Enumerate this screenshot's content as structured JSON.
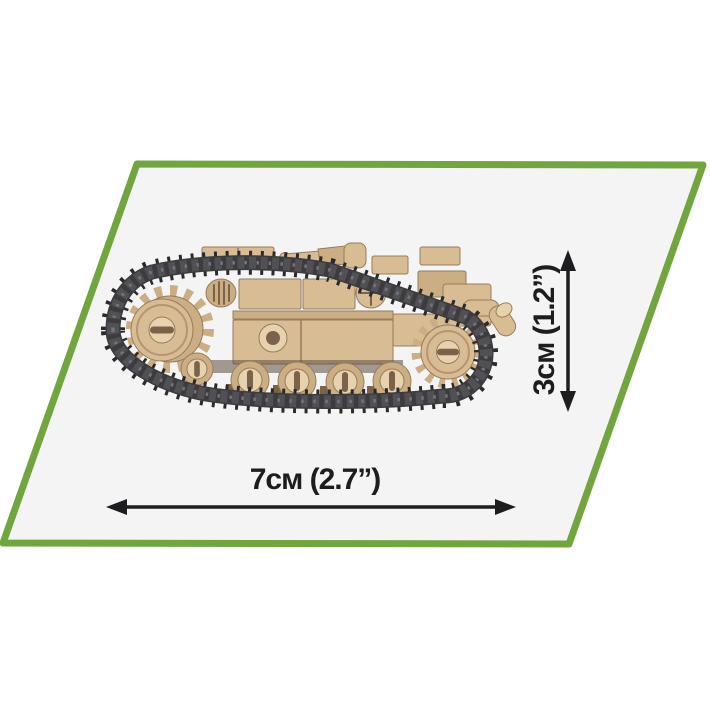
{
  "figure": {
    "description": "Scale diagram of a tan COBI brick-built tank (side view) inside a green-outlined parallelogram",
    "dimensions": {
      "width_label": "7см (2.7”)",
      "height_label": "3см (1.2”)"
    }
  },
  "colors": {
    "page_bg": "#ffffff",
    "panel_fill": "#f4f4f5",
    "accent_green": "#71a63f",
    "ink": "#1d1d1f",
    "brick_tan": "#d8bc94",
    "brick_tan_light": "#e6d3ae",
    "brick_tan_mid": "#cbae83",
    "brick_tan_dark": "#b39672",
    "brick_outline": "#977c5a",
    "slot_brown": "#7a634a",
    "track_band": "#3c3c3e",
    "track_cleat": "#2a2a2c",
    "track_link": "#505055",
    "track_stud": "#73737a",
    "under_shadow": "#5d4e3e"
  }
}
